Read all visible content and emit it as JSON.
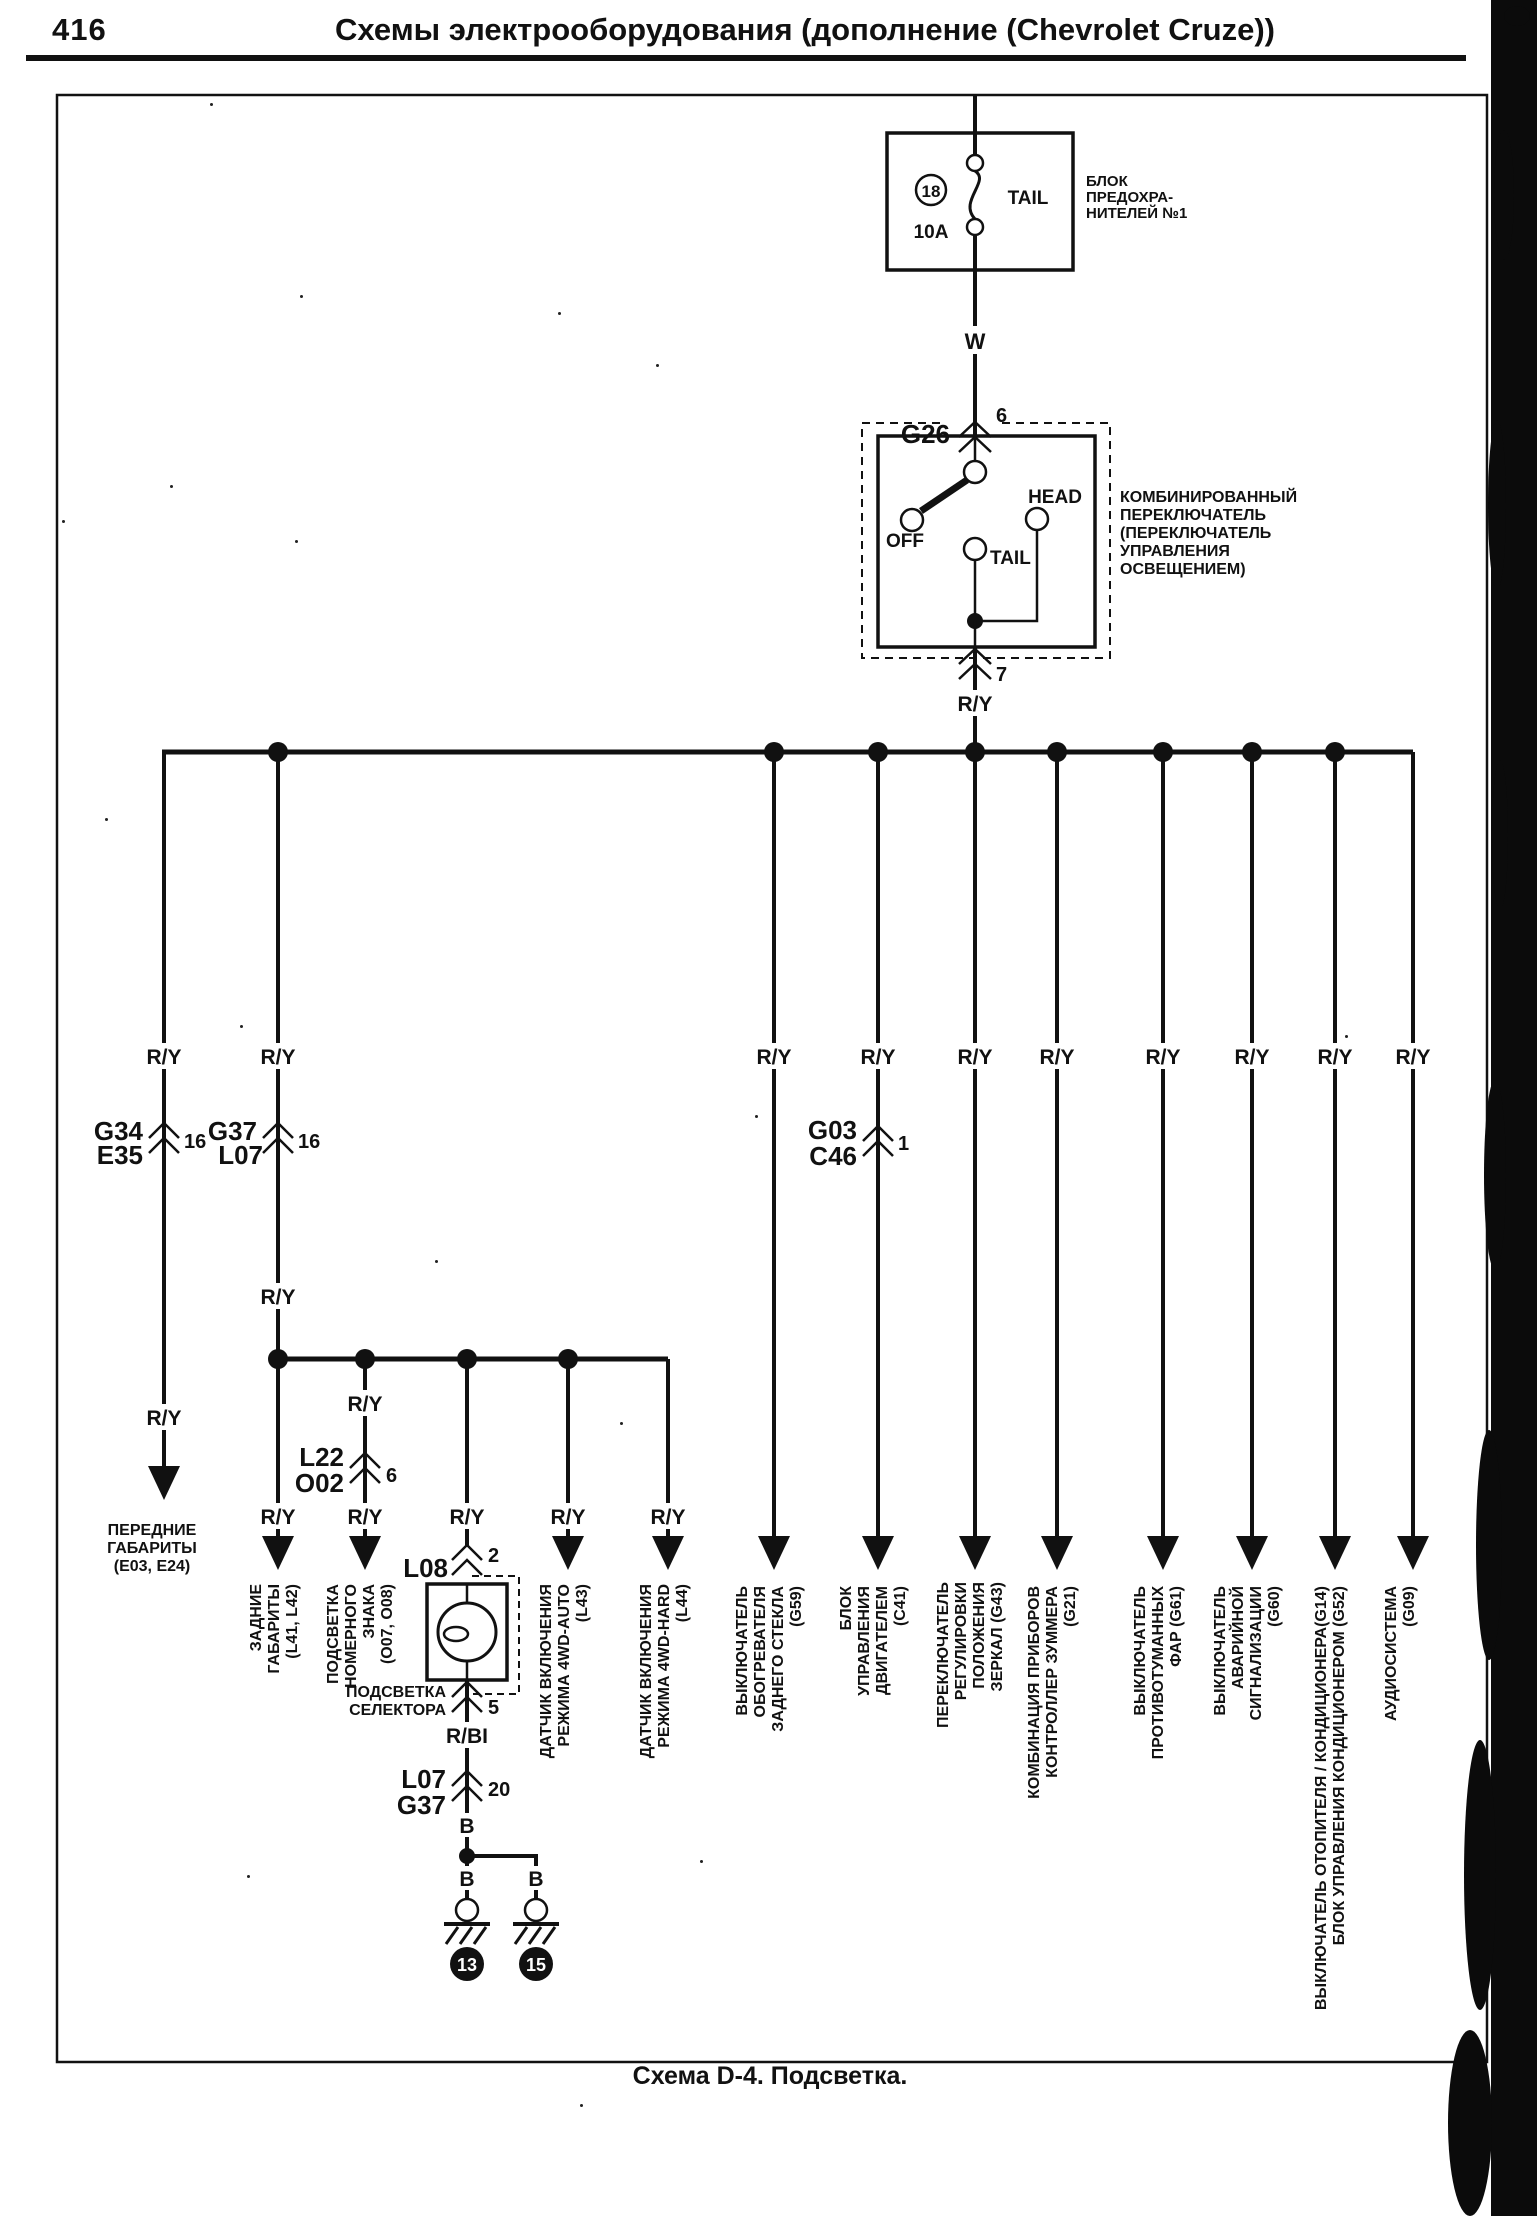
{
  "page": {
    "number": "416",
    "title": "Схемы электрооборудования (дополнение (Chevrolet Cruze))",
    "caption": "Схема D-4. Подсветка."
  },
  "colors": {
    "ink": "#111111",
    "paper": "#ffffff"
  },
  "fuse_block": {
    "fuse_number": "18",
    "rating": "10A",
    "circuit": "TAIL",
    "label": [
      "БЛОК",
      "ПРЕДОХРА-",
      "НИТЕЛЕЙ №1"
    ]
  },
  "wires": {
    "feed": "W",
    "main": "R/Y",
    "selector": "R/BI",
    "ground": "B"
  },
  "connectors": {
    "g26": {
      "name": "G26",
      "pin": "6"
    },
    "switch_output_pin": "7",
    "g34_e35": {
      "line1": "G34",
      "line2": "E35",
      "pin": "16"
    },
    "g37_l07": {
      "line1": "G37",
      "line2": "L07",
      "pin": "16"
    },
    "g03_c46": {
      "line1": "G03",
      "line2": "C46",
      "pin": "1"
    },
    "l22_o02": {
      "line1": "L22",
      "line2": "O02",
      "pin": "6"
    },
    "l08": {
      "name": "L08",
      "pin": "2"
    },
    "selector_out_pin": "5",
    "l07_g37": {
      "line1": "L07",
      "line2": "G37",
      "pin": "20"
    }
  },
  "light_switch": {
    "position_off": "OFF",
    "position_tail": "TAIL",
    "position_head": "HEAD",
    "label": [
      "КОМБИНИРОВАННЫЙ",
      "ПЕРЕКЛЮЧАТЕЛЬ",
      "(ПЕРЕКЛЮЧАТЕЛЬ",
      "УПРАВЛЕНИЯ",
      "ОСВЕЩЕНИЕМ)"
    ]
  },
  "selector_light_label": [
    "ПОДСВЕТКА",
    "СЕЛЕКТОРА"
  ],
  "grounds": [
    {
      "wire": "B",
      "id": "13"
    },
    {
      "wire": "B",
      "id": "15"
    }
  ],
  "destinations": {
    "front_lights": [
      "ПЕРЕДНИЕ",
      "ГАБАРИТЫ",
      "(E03, E24)"
    ],
    "rear_lights": [
      "ЗАДНИЕ",
      "ГАБАРИТЫ",
      "(L41, L42)"
    ],
    "license_plate": [
      "ПОДСВЕТКА",
      "НОМЕРНОГО",
      "ЗНАКА",
      "(O07, O08)"
    ],
    "awd_auto": [
      "ДАТЧИК ВКЛЮЧЕНИЯ",
      "РЕЖИМА 4WD-AUTO",
      "(L43)"
    ],
    "awd_hard": [
      "ДАТЧИК ВКЛЮЧЕНИЯ",
      "РЕЖИМА 4WD-HARD",
      "(L44)"
    ],
    "rear_defogger": [
      "ВЫКЛЮЧАТЕЛЬ",
      "ОБОГРЕВАТЕЛЯ",
      "ЗАДНЕГО СТЕКЛА",
      "(G59)"
    ],
    "engine_ecu": [
      "БЛОК",
      "УПРАВЛЕНИЯ",
      "ДВИГАТЕЛЕМ",
      "(C41)"
    ],
    "mirror_switch": [
      "ПЕРЕКЛЮЧАТЕЛЬ",
      "РЕГУЛИРОВКИ",
      "ПОЛОЖЕНИЯ",
      "ЗЕРКАЛ (G43)"
    ],
    "instrument_cluster": [
      "КОМБИНАЦИЯ ПРИБОРОВ",
      "КОНТРОЛЛЕР ЗУММЕРА",
      "(G21)"
    ],
    "fog_switch": [
      "ВЫКЛЮЧАТЕЛЬ",
      "ПРОТИВОТУМАННЫХ",
      "ФАР (G61)"
    ],
    "hazard_switch": [
      "ВЫКЛЮЧАТЕЛЬ",
      "АВАРИЙНОЙ",
      "СИГНАЛИЗАЦИИ",
      "(G60)"
    ],
    "hvac": [
      "ВЫКЛЮЧАТЕЛЬ ОТОПИТЕЛЯ / КОНДИЦИОНЕРА(G14)",
      "БЛОК УПРАВЛЕНИЯ КОНДИЦИОНЕРОМ (G52)"
    ],
    "audio": [
      "АУДИОСИСТЕМА",
      "(G09)"
    ]
  }
}
